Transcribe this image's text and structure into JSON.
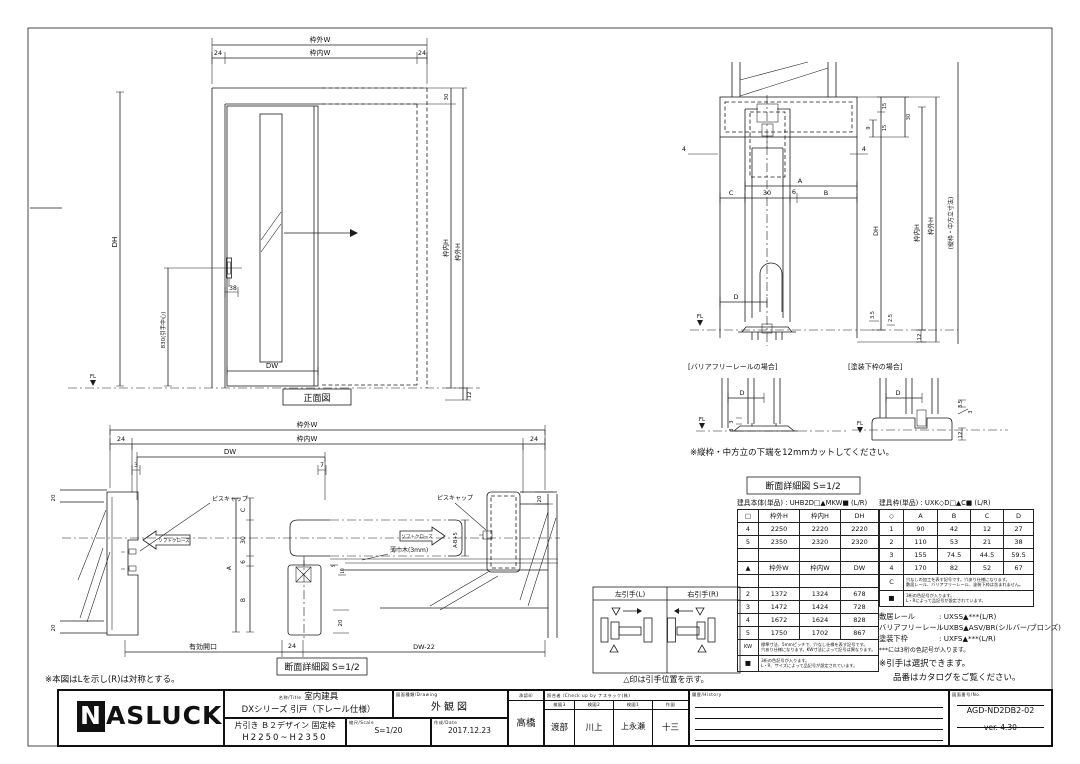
{
  "front": {
    "caption": "正面図",
    "wakugai_w": "枠外W",
    "wakunai_w": "枠内W",
    "left24": "24",
    "right24": "24",
    "dh": "DH",
    "dw": "DW",
    "handle_center": "830(引手中心)",
    "handle38": "38",
    "top30": "30",
    "bottom12": "12",
    "fl": "FL",
    "wakunai_h": "枠内H",
    "wakugai_h": "枠外H"
  },
  "section": {
    "left4": "4",
    "right4": "4",
    "a": "A",
    "b": "B",
    "c": "C",
    "d": "D",
    "n30": "30",
    "n6": "6",
    "fl": "FL",
    "r15a": "15",
    "r15b": "15",
    "r9": "9",
    "r30": "30",
    "dh": "DH",
    "wakunai_h": "枠内H",
    "wakugai_h": "枠外H",
    "outer_note": "(縦枠・中方立寸法)",
    "b35": "3.5",
    "b25": "2.5",
    "b12": "12",
    "note": "※縦枠・中方立の下端を12mmカットしてください。",
    "caption": "断面詳細図 S=1/2",
    "detail1_caption": "[バリアフリーレールの場合]",
    "d1_d": "D",
    "d1_fl": "FL",
    "d1_3a": "3",
    "d1_3b": "3",
    "detail2_caption": "[塗装下枠の場合]",
    "d2_d": "D",
    "d2_fl": "FL",
    "d2_35": "3.5",
    "d2_3": "3",
    "d2_12": "12"
  },
  "plan": {
    "wakugai_w": "枠外W",
    "wakunai_w": "枠内W",
    "dw": "DW",
    "left24": "24",
    "right24": "24",
    "n3": "3",
    "n7": "7",
    "tl20": "20",
    "bl20": "20",
    "tr20": "20",
    "i20": "20",
    "c": "C",
    "n30": "30",
    "n6": "6",
    "a": "A",
    "b": "B",
    "n5": "5",
    "n10": "10",
    "ab5": "A-B+5",
    "piscap_l": "ピスキャップ",
    "piscap_r": "ピスキャップ",
    "softclose_l": "ソフトクローズ",
    "softclose_r": "ソフトクローズ",
    "skirting": "薄巾木(3mm)",
    "opening": "有効開口",
    "bottom24": "24",
    "dw22": "DW-22",
    "caption": "断面詳細図 S=1/2",
    "note": "※本図はLを示し(R)は対称とする。"
  },
  "handle": {
    "left": "左引手(L)",
    "right": "右引手(R)",
    "note": "△印は引手位置を示す。"
  },
  "body_table": {
    "title": "建具本体(単品) : UHB2D□▲MKW■ (L/R)",
    "hh": [
      "□",
      "枠外H",
      "枠内H",
      "DH"
    ],
    "r1": [
      "4",
      "2250",
      "2220",
      "2220"
    ],
    "r2": [
      "5",
      "2350",
      "2320",
      "2320"
    ],
    "wh": [
      "▲",
      "枠外W",
      "枠内W",
      "DW"
    ],
    "r3": [
      "2",
      "1372",
      "1324",
      "678"
    ],
    "r4": [
      "3",
      "1472",
      "1424",
      "728"
    ],
    "r5": [
      "4",
      "1672",
      "1624",
      "828"
    ],
    "r6": [
      "5",
      "1750",
      "1702",
      "867"
    ],
    "kw": "KW",
    "kw_note1": "標準寸法、5mmピッチで、穴なし仕様を表す記号です。",
    "kw_note2": "穴あり仕様になります。KW寸法によって記号は異なります。",
    "sq": "■",
    "sq_note1": "3桁の色記号が入ります。",
    "sq_note2": "L・R、サイズによって品記号が設定されています。"
  },
  "frame_table": {
    "title": "建具枠(単品) : UXK◇D□▲C■ (L/R)",
    "hh": [
      "◇",
      "A",
      "B",
      "C",
      "D"
    ],
    "r1": [
      "1",
      "90",
      "42",
      "12",
      "27"
    ],
    "r2": [
      "2",
      "110",
      "53",
      "21",
      "38"
    ],
    "r3": [
      "3",
      "155",
      "74.5",
      "44.5",
      "59.5"
    ],
    "r4": [
      "4",
      "170",
      "82",
      "52",
      "67"
    ],
    "c": "C",
    "c_note1": "穴なしの加工を表す記号です。穴あり仕様になります。",
    "c_note2": "敷居レール、バリアフリーレール、塗装下枠は含まれません。",
    "sq": "■",
    "sq_note1": "3桁の色記号が入ります。",
    "sq_note2": "L・Rによって品記号が設定されています。"
  },
  "rails": {
    "l1_label": "敷居レール",
    "l1_value": ": UXSS▲***(L/R)",
    "l2_label": "バリアフリーレール",
    "l2_value": ": UXBS▲ASV/BR(シルバー/ブロンズ)",
    "l3_label": "塗装下枠",
    "l3_value": ": UXFS▲***(L/R)",
    "note1": "***には3桁の色記号が入ります。",
    "note2": "※引手は選択できます。",
    "note3": "品番はカタログをご覧ください。"
  },
  "title_block": {
    "logo": "NASLUCK",
    "name_label": "名称/Title",
    "name1": "室内建具",
    "name2": "DXシリーズ 引戸（下レール仕様）",
    "name3": "片引き Ｂ２デザイン 固定枠",
    "name4": "H2250~H2350",
    "drawing_label": "図面種類/Drawing",
    "drawing_value": "外観図",
    "scale_label": "縮尺/Scale",
    "scale_value": "S=1/20",
    "date_label": "作成/Date",
    "date_value": "2017.12.23",
    "approve_label": "承認印",
    "approver": "高橋",
    "check_label": "照合者 /Check up by ナスラック(株)",
    "c1_label": "検図3",
    "c1_name": "渡部",
    "c2_label": "検図2",
    "c2_name": "川上",
    "c3_label": "検図1",
    "c3_name": "上永瀬",
    "c4_label": "作図",
    "c4_name": "十三",
    "history_label": "履歴/History",
    "no_label": "図面番号/No.",
    "no_value": "AGD-ND2DB2-02",
    "version": "ver. 4.30"
  }
}
